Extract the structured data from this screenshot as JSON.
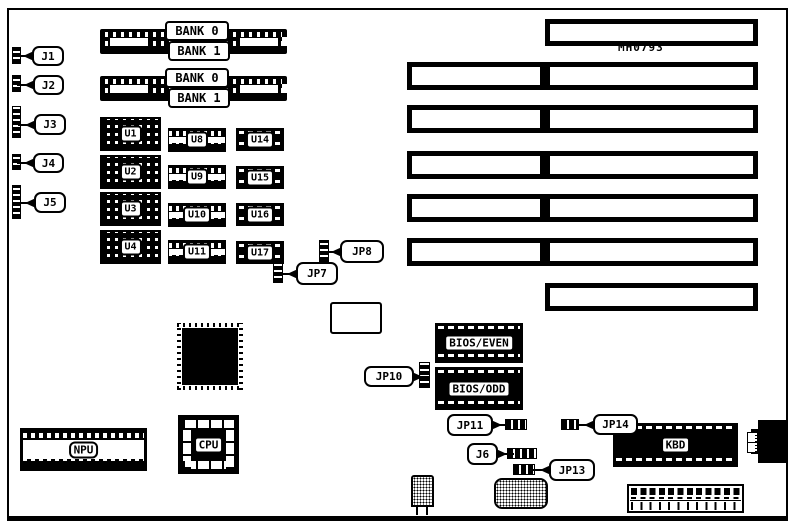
{
  "colors": {
    "ink": "#000000",
    "paper": "#ffffff"
  },
  "board": {
    "part_number": "MH0793",
    "memory": {
      "bank0_label": "BANK 0",
      "bank1_label": "BANK 1",
      "simm_groups": 2
    },
    "left_connectors": [
      {
        "label": "J1"
      },
      {
        "label": "J2"
      },
      {
        "label": "J3"
      },
      {
        "label": "J4"
      },
      {
        "label": "J5"
      }
    ],
    "dram_chips": [
      {
        "label": "U1"
      },
      {
        "label": "U2"
      },
      {
        "label": "U3"
      },
      {
        "label": "U4"
      },
      {
        "label": "U8"
      },
      {
        "label": "U9"
      },
      {
        "label": "U10"
      },
      {
        "label": "U11"
      },
      {
        "label": "U14"
      },
      {
        "label": "U15"
      },
      {
        "label": "U16"
      },
      {
        "label": "U17"
      }
    ],
    "jumpers": [
      {
        "label": "JP7"
      },
      {
        "label": "JP8"
      },
      {
        "label": "JP10"
      },
      {
        "label": "JP11"
      },
      {
        "label": "JP13"
      },
      {
        "label": "JP14"
      }
    ],
    "connector_j6": {
      "label": "J6"
    },
    "rom_chips": [
      {
        "label": "BIOS/EVEN"
      },
      {
        "label": "BIOS/ODD"
      }
    ],
    "keyboard_controller": {
      "label": "KBD"
    },
    "processors": {
      "cpu_label": "CPU",
      "npu_label": "NPU"
    },
    "expansion_slots": {
      "long_count": 7,
      "short_count": 5
    }
  }
}
